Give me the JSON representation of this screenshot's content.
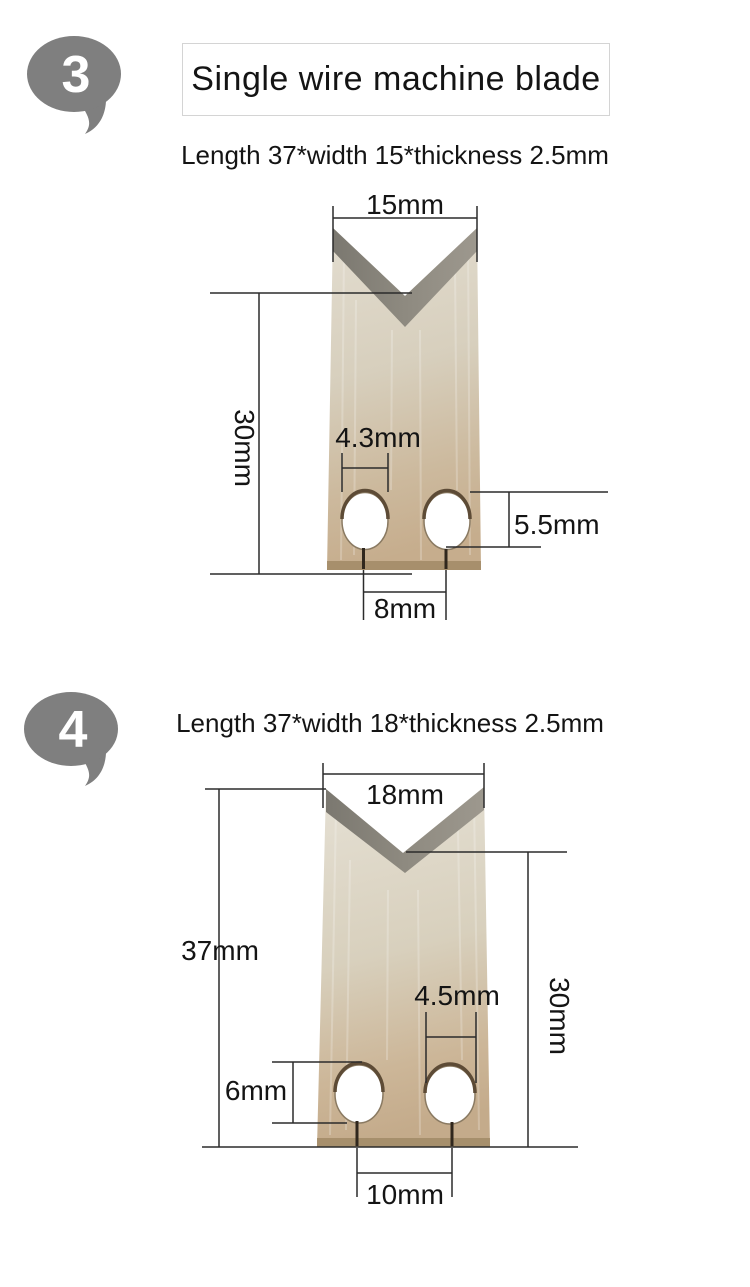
{
  "colors": {
    "bubble_gray": "#7f7f7f",
    "blade_top": "#e2dccf",
    "blade_bottom": "#c6ad8d",
    "bevel_dark": "#767369",
    "bevel_light": "#9d988e",
    "dimension_line": "#2b2b2b",
    "text": "#141414",
    "title_border": "#d4d4d4"
  },
  "section3": {
    "step": "3",
    "title": "Single wire machine blade",
    "spec": "Length 37*width 15*thickness 2.5mm",
    "dims": {
      "top_width": "15mm",
      "edge_height": "30mm",
      "hole_width": "4.3mm",
      "hole_height": "5.5mm",
      "slit_spacing": "8mm"
    }
  },
  "section4": {
    "step": "4",
    "spec": "Length 37*width 18*thickness 2.5mm",
    "dims": {
      "top_width": "18mm",
      "total_length": "37mm",
      "hole_width": "4.5mm",
      "edge_height": "30mm",
      "hole_height": "6mm",
      "slit_spacing": "10mm"
    }
  }
}
